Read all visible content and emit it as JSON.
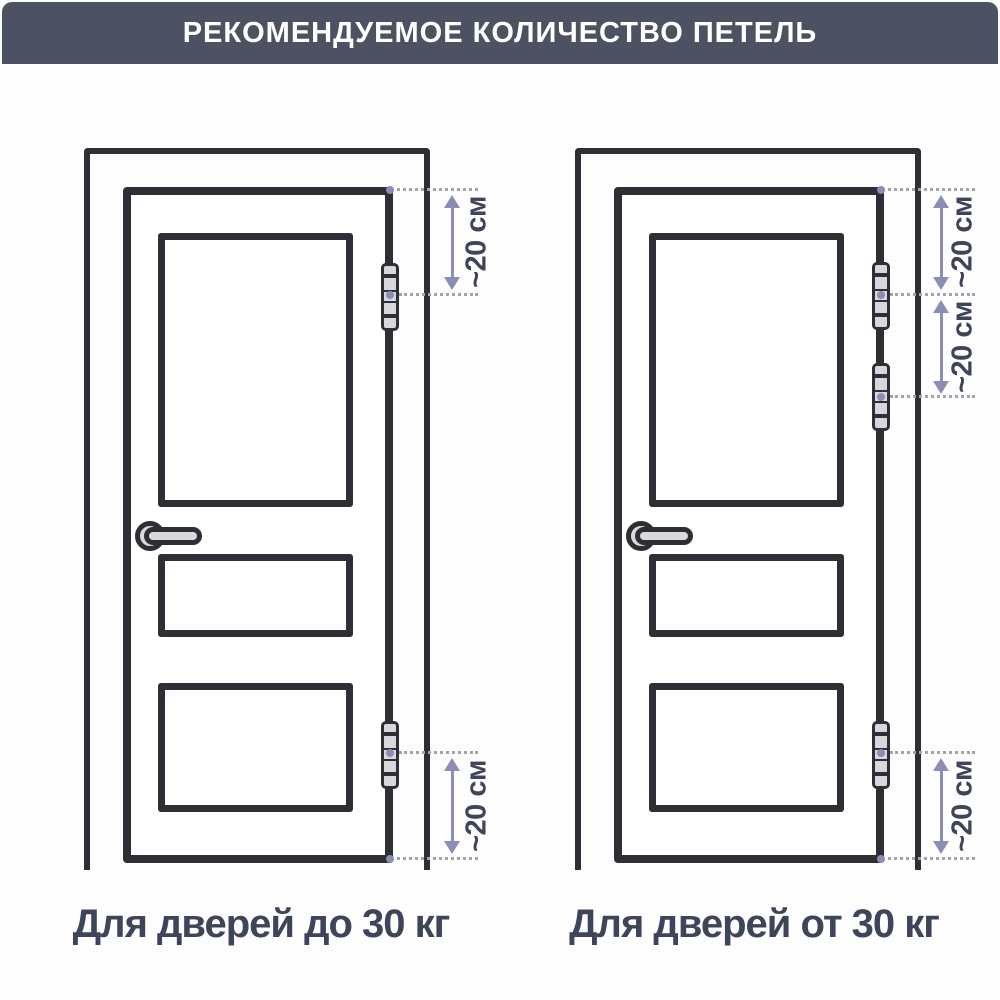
{
  "header": {
    "title": "РЕКОМЕНДУЕМОЕ КОЛИЧЕСТВО ПЕТЕЛЬ"
  },
  "diagrams": {
    "light": {
      "caption": "Для дверей до 30 кг",
      "hinge_count": 2,
      "dimensions": {
        "top": "~20 см",
        "bottom": "~20 см"
      }
    },
    "heavy": {
      "caption": "Для дверей от 30 кг",
      "hinge_count": 3,
      "dimensions": {
        "top": "~20 см",
        "middle": "~20 см",
        "bottom": "~20 см"
      }
    }
  },
  "colors": {
    "header_bg": "#4c5262",
    "header_text": "#ffffff",
    "line": "#2e2f34",
    "caption_text": "#3e4459",
    "dimension_text": "#3f4459",
    "arrow": "#8b8db4",
    "dotted_line": "#a2a3ae",
    "hinge_fill": "#d8d8dc",
    "handle_fill": "#dadade"
  }
}
